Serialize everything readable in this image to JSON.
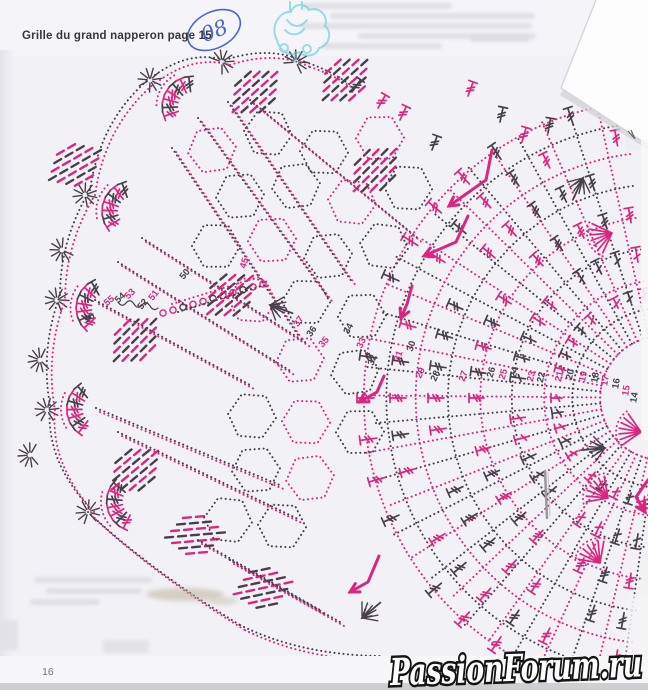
{
  "page": {
    "header": "Grille du grand napperon page 15",
    "handwritten_mark": "08",
    "page_number": "16",
    "watermark": "PassionForum.ru"
  },
  "chart": {
    "type": "crochet-doily-grille",
    "colors": {
      "pink": "#d9277f",
      "dark": "#474049",
      "stamp_cyan": "#4fc8d6",
      "pen_blue": "#4b67cb",
      "paper": "#f2f1f6"
    },
    "round_numbers": [
      {
        "t": "56",
        "x": 91,
        "y": 320,
        "r": -35,
        "c": "d"
      },
      {
        "t": "55",
        "x": 111,
        "y": 303,
        "r": -40,
        "c": "p"
      },
      {
        "t": "54",
        "x": 122,
        "y": 300,
        "r": -42,
        "c": "d"
      },
      {
        "t": "53",
        "x": 132,
        "y": 296,
        "r": -44,
        "c": "p"
      },
      {
        "t": "52",
        "x": 145,
        "y": 306,
        "r": -50,
        "c": "d"
      },
      {
        "t": "51",
        "x": 156,
        "y": 297,
        "r": -52,
        "c": "p"
      },
      {
        "t": "50",
        "x": 187,
        "y": 276,
        "r": -50,
        "c": "d"
      },
      {
        "t": "45",
        "x": 247,
        "y": 264,
        "r": -72,
        "c": "p"
      },
      {
        "t": "37",
        "x": 301,
        "y": 323,
        "r": -55,
        "c": "p"
      },
      {
        "t": "36",
        "x": 314,
        "y": 333,
        "r": -55,
        "c": "d"
      },
      {
        "t": "35",
        "x": 326,
        "y": 344,
        "r": -48,
        "c": "p"
      },
      {
        "t": "34",
        "x": 351,
        "y": 330,
        "r": -62,
        "c": "d"
      },
      {
        "t": "33",
        "x": 364,
        "y": 344,
        "r": -66,
        "c": "p"
      },
      {
        "t": "32",
        "x": 375,
        "y": 361,
        "r": -70,
        "c": "d"
      },
      {
        "t": "31",
        "x": 401,
        "y": 357,
        "r": -70,
        "c": "p"
      },
      {
        "t": "30",
        "x": 414,
        "y": 347,
        "r": -72,
        "c": "d"
      },
      {
        "t": "29",
        "x": 423,
        "y": 374,
        "r": -66,
        "c": "p"
      },
      {
        "t": "28",
        "x": 438,
        "y": 377,
        "r": -66,
        "c": "d"
      },
      {
        "t": "27",
        "x": 466,
        "y": 377,
        "r": -70,
        "c": "p"
      },
      {
        "t": "26",
        "x": 494,
        "y": 373,
        "r": -74,
        "c": "d"
      },
      {
        "t": "25",
        "x": 506,
        "y": 375,
        "r": -74,
        "c": "p"
      },
      {
        "t": "24",
        "x": 517,
        "y": 373,
        "r": -76,
        "c": "d"
      },
      {
        "t": "23",
        "x": 534,
        "y": 377,
        "r": -76,
        "c": "p"
      },
      {
        "t": "22",
        "x": 544,
        "y": 378,
        "r": -76,
        "c": "d"
      },
      {
        "t": "21",
        "x": 562,
        "y": 377,
        "r": -76,
        "c": "p"
      },
      {
        "t": "20",
        "x": 573,
        "y": 375,
        "r": -78,
        "c": "d"
      },
      {
        "t": "19",
        "x": 586,
        "y": 377,
        "r": -78,
        "c": "p"
      },
      {
        "t": "18",
        "x": 598,
        "y": 378,
        "r": -80,
        "c": "d"
      },
      {
        "t": "17",
        "x": 608,
        "y": 381,
        "r": -80,
        "c": "p"
      },
      {
        "t": "16",
        "x": 619,
        "y": 384,
        "r": -80,
        "c": "d"
      },
      {
        "t": "15",
        "x": 629,
        "y": 391,
        "r": -80,
        "c": "p"
      },
      {
        "t": "14",
        "x": 637,
        "y": 398,
        "r": -80,
        "c": "d"
      }
    ]
  }
}
